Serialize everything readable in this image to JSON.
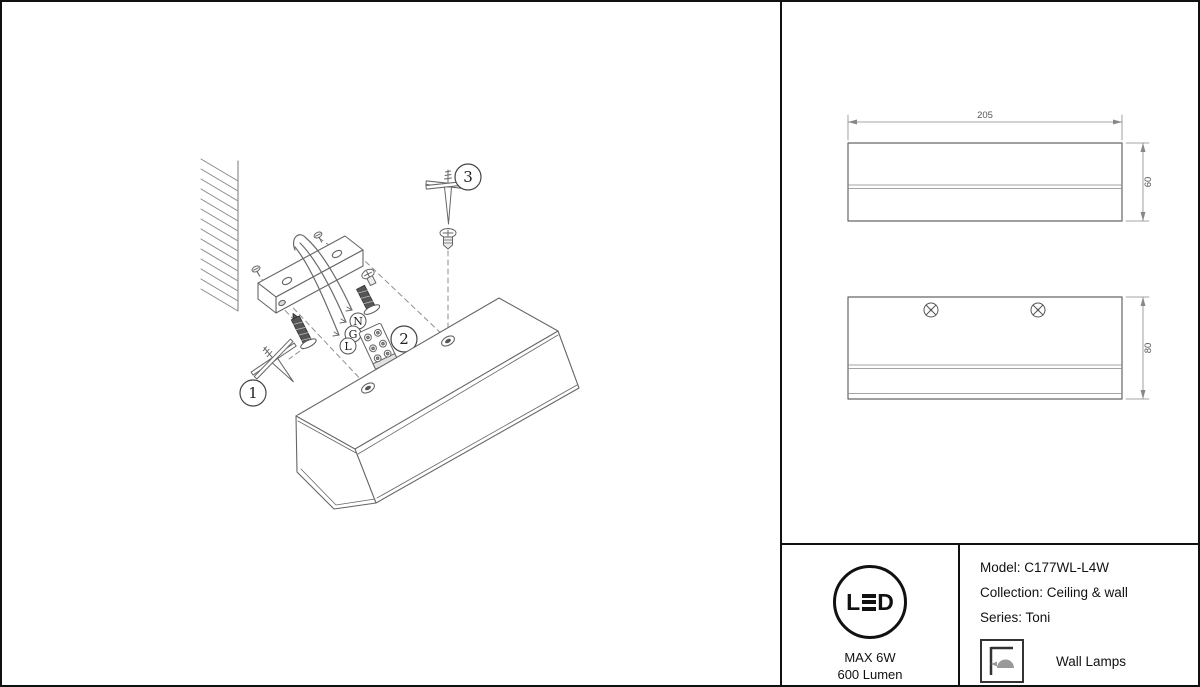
{
  "diagram": {
    "callouts": {
      "c1": "1",
      "c2": "2",
      "c3": "3"
    },
    "wires": {
      "n": "N",
      "g": "G",
      "l": "L"
    }
  },
  "drawings": {
    "top_view": {
      "width_label": "205",
      "height_label": "60"
    },
    "front_view": {
      "height_label": "80"
    }
  },
  "info": {
    "led": {
      "letter_l": "L",
      "letter_d": "D"
    },
    "max_power": "MAX 6W",
    "lumen": "600 Lumen",
    "model": "Model: C177WL-L4W",
    "collection": "Collection: Ceiling & wall",
    "series": "Series: Toni",
    "category": "Wall Lamps"
  },
  "colors": {
    "line": "#666666",
    "dark_line": "#111111",
    "fill_dark": "#555555",
    "background": "#ffffff"
  }
}
